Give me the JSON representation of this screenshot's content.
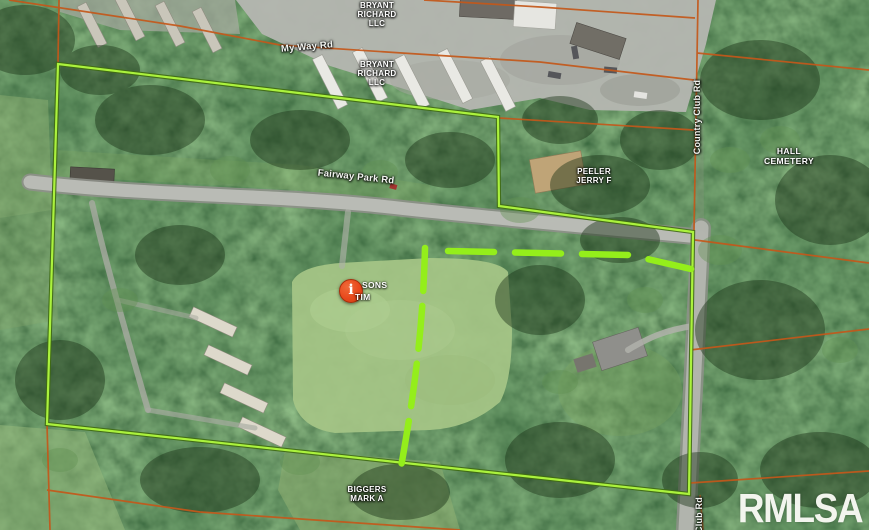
{
  "map": {
    "road_labels": {
      "my_way_rd": "My Way Rd",
      "fairway_park_rd": "Fairway Park Rd",
      "country_club_rd": "Country Club Rd",
      "club_rd_partial": "Club Rd"
    },
    "parcel_labels": {
      "bryant_richard_line1": "BRYANT",
      "bryant_richard_line2": "RICHARD",
      "bryant_richard_line3": "LLC",
      "peeler_line1": "PEELER",
      "peeler_line2": "JERRY F",
      "hall_line1": "HALL",
      "hall_line2": "CEMETERY",
      "biggers_line1": "BIGGERS",
      "biggers_line2": "MARK A"
    },
    "pin": {
      "glyph": "i",
      "label_line1": "SONS",
      "label_line2": "TIM"
    },
    "watermark": "RMLSA",
    "colors": {
      "boundary_green": "#abf23d",
      "boundary_outline": "#3f6a12",
      "dashed_green": "#94ee1b",
      "parcel_orange": "#c4581a",
      "pin_red": "#e8491d",
      "watermark_white": "#f8f9f3"
    }
  }
}
